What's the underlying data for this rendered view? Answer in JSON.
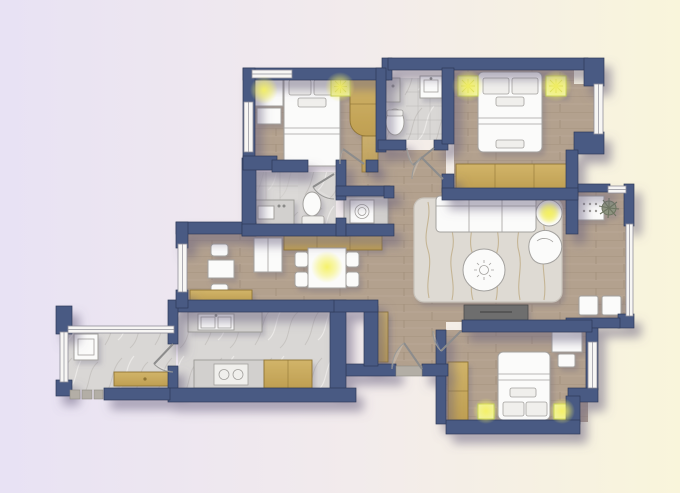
{
  "colors": {
    "background_left": "#e8e2f4",
    "background_right": "#f9f5db",
    "wall": "#4a5a83",
    "wall_outline": "#2e3a59",
    "wood_floor": "#b3a18e",
    "wood_grain": "#a4927e",
    "marble_floor": "#d9d7d5",
    "marble_vein": "#c7c4c1",
    "tile_line": "#969492",
    "cabinet_gold_light": "#d1b469",
    "cabinet_gold": "#bf9f52",
    "cabinet_gold_dark": "#8f7434",
    "furniture_fill": "#fbfbfa",
    "furniture_outline": "#a3a19e",
    "rug_fill": "#dedad3",
    "rug_vein": "#b49d6d",
    "glow": "#f5f163",
    "fixture_fill": "#eef2bb",
    "fixture_stroke": "#b9c74e",
    "tv_fill": "#6e6e6e",
    "stone": "#b3aea6",
    "plant": "#8e9480",
    "window_fill": "#f7f6f4",
    "window_stroke": "#8f8f99",
    "door_arc": "#9a9a98",
    "shadow": "#6a6280"
  },
  "rooms": [
    {
      "id": "bedroom-top-left",
      "floor": "wood"
    },
    {
      "id": "bathroom-top",
      "floor": "marble"
    },
    {
      "id": "master-bedroom",
      "floor": "wood"
    },
    {
      "id": "bathroom-middle",
      "floor": "marble"
    },
    {
      "id": "laundry-niche",
      "floor": "marble"
    },
    {
      "id": "entry-hall",
      "floor": "wood"
    },
    {
      "id": "dining-area",
      "floor": "wood"
    },
    {
      "id": "kitchen",
      "floor": "marble"
    },
    {
      "id": "balcony-left",
      "floor": "marble"
    },
    {
      "id": "living-room",
      "floor": "wood"
    },
    {
      "id": "balcony-right",
      "floor": "wood"
    },
    {
      "id": "bedroom-bottom",
      "floor": "wood"
    }
  ],
  "furniture": [
    "double-bed",
    "desk",
    "dresser",
    "wardrobe",
    "toilet",
    "sink",
    "shower",
    "washing-machine",
    "fridge",
    "dining-table",
    "dining-chair",
    "sideboard",
    "kitchen-sink",
    "stove",
    "bench",
    "sofa",
    "coffee-table",
    "accent-chair",
    "floor-lamp",
    "tv-console",
    "side-cabinet",
    "potted-plant",
    "nightstand",
    "stool",
    "seat-cushion"
  ],
  "lighting": {
    "glow_points": 8
  }
}
